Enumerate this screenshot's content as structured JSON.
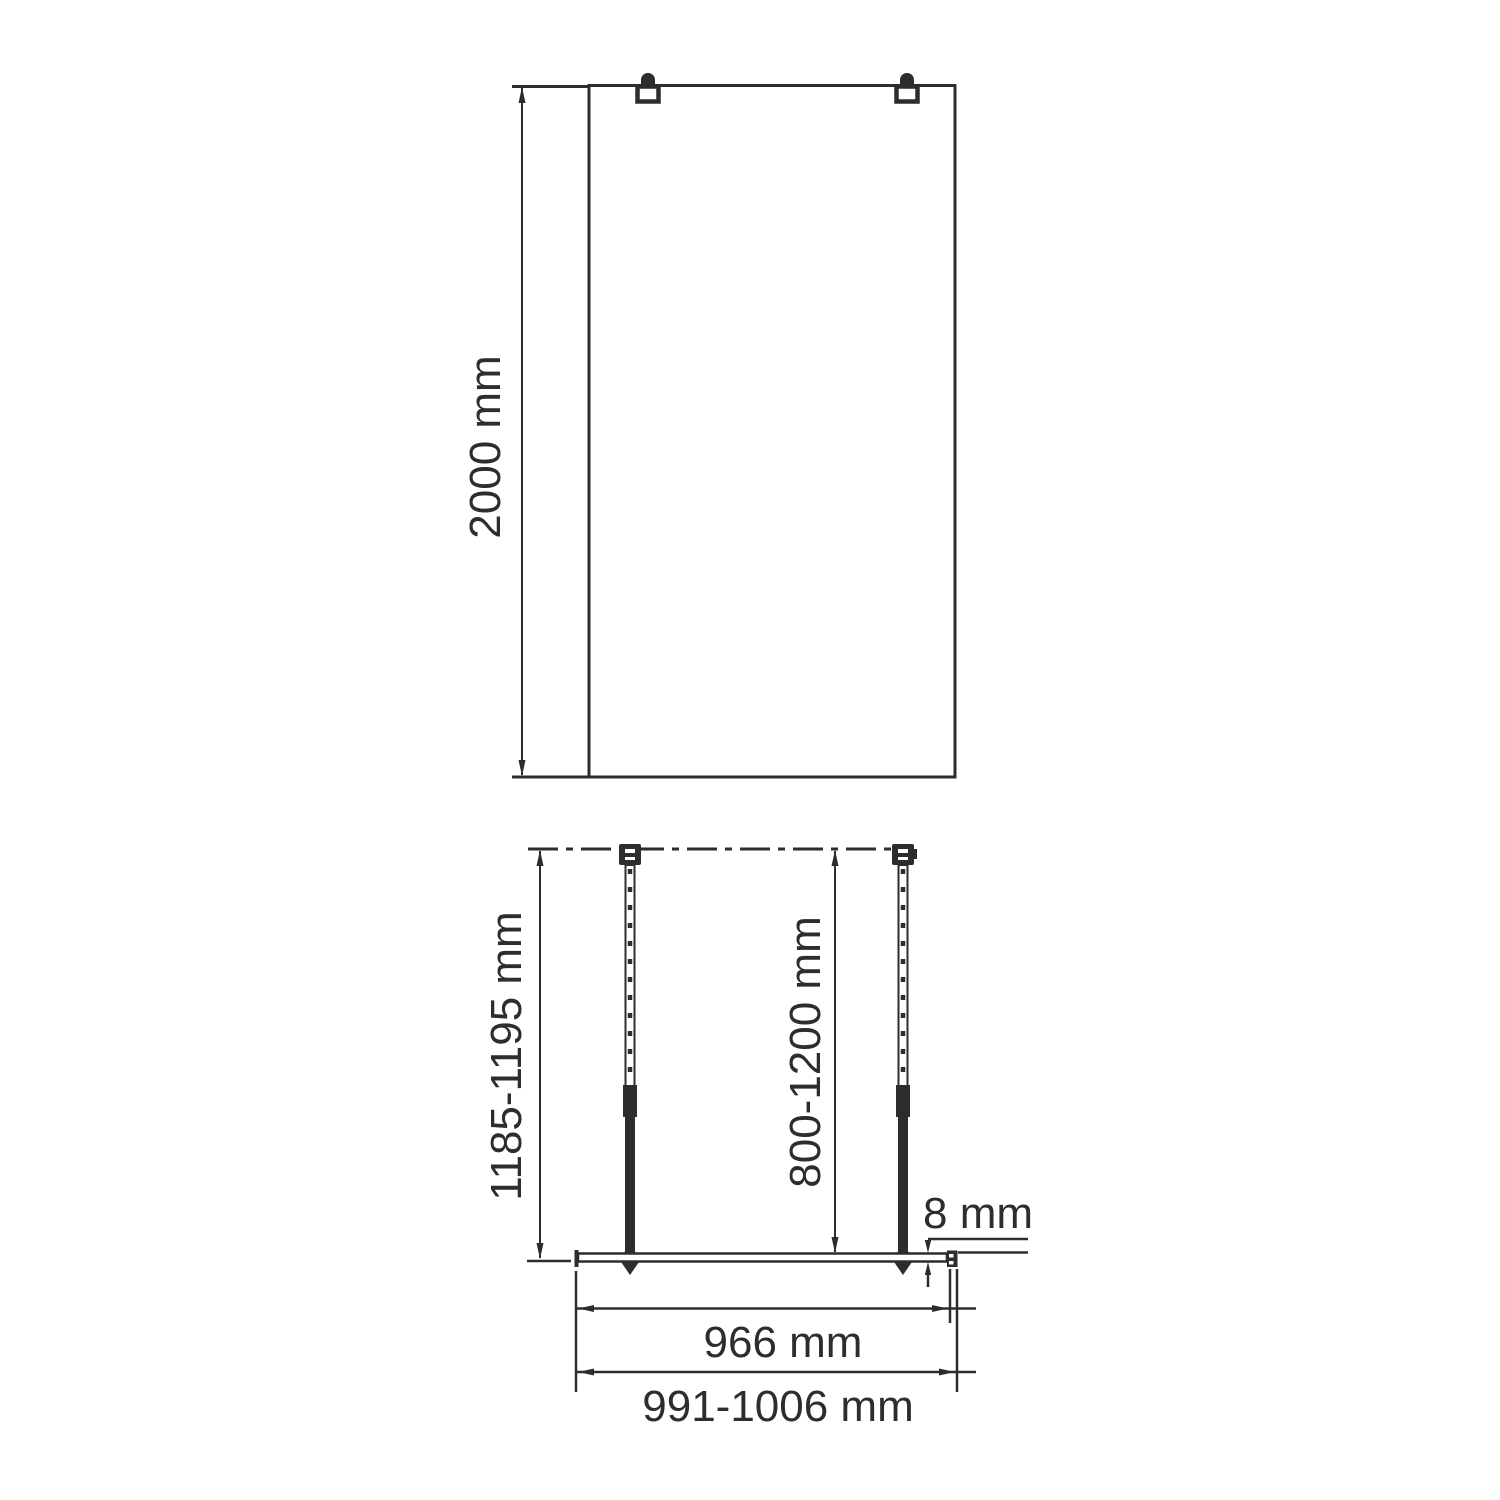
{
  "colors": {
    "line": "#2d2d2d",
    "background": "#ffffff"
  },
  "front_view": {
    "height_dimension": "2000 mm"
  },
  "plan_view": {
    "bar_length_dimension": "1185-1195 mm",
    "bar_adjust_range_dimension": "800-1200 mm",
    "glass_thickness_dimension": "8 mm",
    "glass_width_dimension": "966 mm",
    "overall_width_dimension": "991-1006 mm"
  }
}
